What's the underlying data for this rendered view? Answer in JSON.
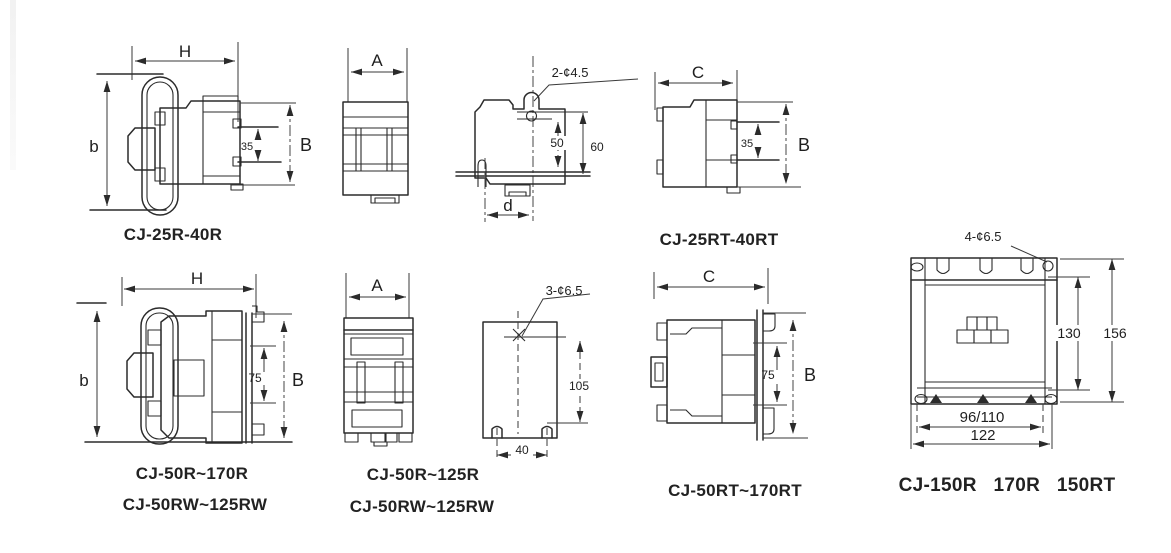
{
  "colors": {
    "background": "#ffffff",
    "line": "#2b2b2b",
    "text": "#1f1f1f"
  },
  "drawings": {
    "cj25r_side": {
      "caption": "CJ-25R-40R",
      "dim_width": "H",
      "dim_height_left": "b",
      "dim_inner": "35",
      "dim_height_right": "B"
    },
    "cj25r_front": {
      "dim_width": "A"
    },
    "cj25r_mount": {
      "hole_callout": "2-¢4.5",
      "dim_hole_to_rail": "50",
      "dim_total_height": "60",
      "dim_width": "d"
    },
    "cj25rt_side": {
      "caption": "CJ-25RT-40RT",
      "dim_width": "C",
      "dim_inner": "35",
      "dim_height_right": "B"
    },
    "cj50r_side": {
      "captions": [
        "CJ-50R~170R",
        "CJ-50RW~125RW"
      ],
      "dim_width": "H",
      "dim_height_left": "b",
      "dim_inner": "75",
      "dim_height_right": "B"
    },
    "cj50r_front": {
      "captions": [
        "CJ-50R~125R",
        "CJ-50RW~125RW"
      ],
      "dim_width": "A"
    },
    "cj50r_mount": {
      "hole_callout": "3-¢6.5",
      "dim_height": "105",
      "dim_width": "40"
    },
    "cj50rt_side": {
      "caption": "CJ-50RT~170RT",
      "dim_width": "C",
      "dim_inner": "75",
      "dim_height_right": "B"
    },
    "cj150r_front": {
      "caption": "CJ-150R   170R   150RT",
      "hole_callout": "4-¢6.5",
      "dim_inner_height": "130",
      "dim_outer_height": "156",
      "dim_bottom_inner": "96/110",
      "dim_bottom_outer": "122"
    }
  }
}
